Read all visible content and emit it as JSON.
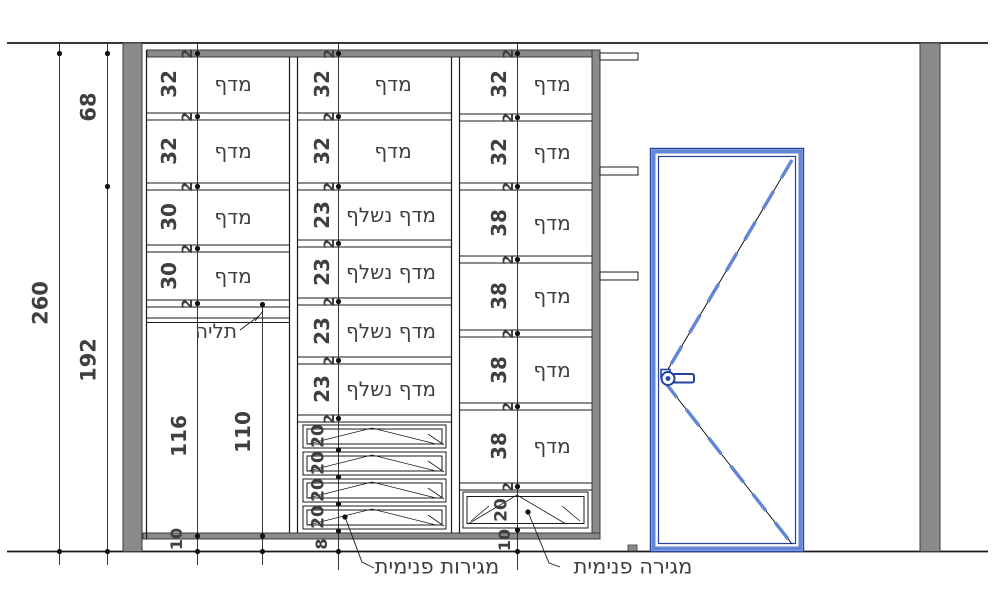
{
  "colors": {
    "wall_gray": "#8a8a8a",
    "line_black": "#1a1a1a",
    "door_blue": "#6285d6",
    "door_blue_dark": "#24429e",
    "text_gray": "#3f3f3f"
  },
  "dims": {
    "total": "260",
    "upper": "68",
    "lower": "192",
    "shelf_t": "2",
    "left": {
      "sizes": [
        "32",
        "32",
        "30",
        "30"
      ],
      "hang_height": "116",
      "rod_height": "110",
      "plinth": "10"
    },
    "middle": {
      "sizes": [
        "32",
        "32",
        "23",
        "23",
        "23",
        "23"
      ],
      "drawers": [
        "20",
        "20",
        "20",
        "20"
      ],
      "plinth": "8"
    },
    "right": {
      "sizes": [
        "32",
        "32",
        "38",
        "38",
        "38",
        "38"
      ],
      "drawer": "20",
      "plinth": "10"
    }
  },
  "labels": {
    "shelf": "מדף",
    "pullout_shelf": "מדף נשלף",
    "hanging": "תליה",
    "internal_drawers": "מגירות פנימית",
    "internal_drawer": "מגירה פנימית"
  }
}
